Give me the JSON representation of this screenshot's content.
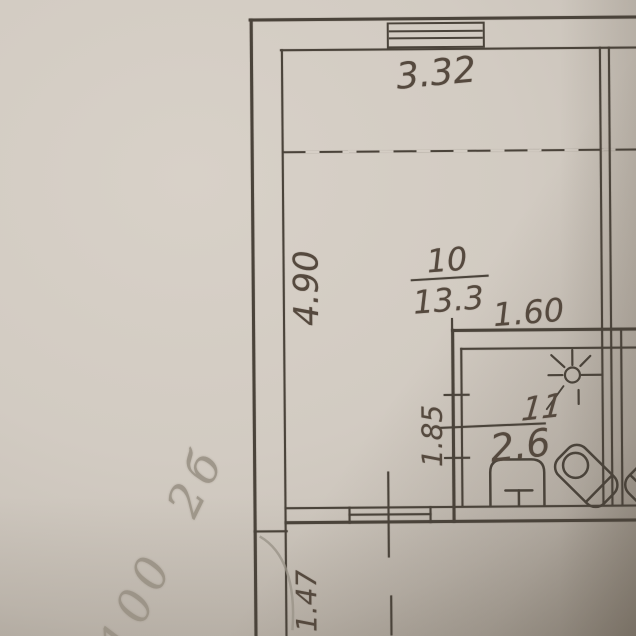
{
  "meta": {
    "description": "photographed architectural floor plan fragment",
    "colors": {
      "ink": "#4a433a",
      "pencil": "#978f82",
      "paper": "#d2cbc2"
    }
  },
  "plan": {
    "dimensions": {
      "top_width": "3.32",
      "left_height": "4.90",
      "bath_width": "1.60",
      "bath_height": "1.85",
      "bottom_left": "1.47"
    },
    "rooms": {
      "main": {
        "number": "10",
        "area": "13.3"
      },
      "bath": {
        "number": "11",
        "area": "2.6"
      }
    },
    "icons": {
      "window": "window-symbol",
      "lamp": "ceiling-light",
      "toilet": "toilet",
      "sink": "washbasin-tilted",
      "door": "door-swing-arc"
    }
  },
  "handwriting": {
    "note": "100 2б"
  }
}
